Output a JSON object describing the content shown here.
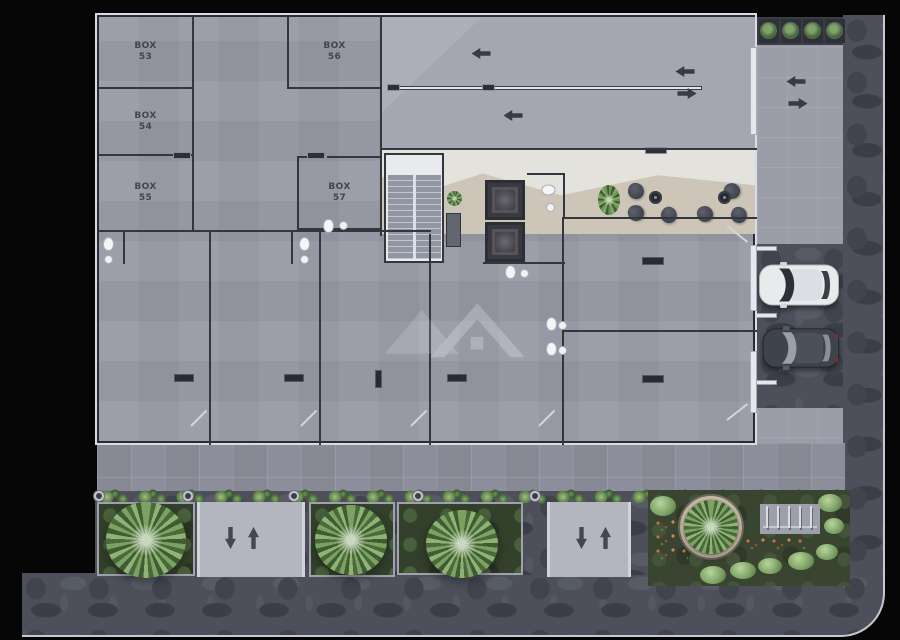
{
  "floor_plan": {
    "box_labels": [
      {
        "label": "BOX",
        "number": "53"
      },
      {
        "label": "BOX",
        "number": "54"
      },
      {
        "label": "BOX",
        "number": "55"
      },
      {
        "label": "BOX",
        "number": "56"
      },
      {
        "label": "BOX",
        "number": "57"
      }
    ],
    "flow_arrows": {
      "ramp_upper_lane": "left",
      "ramp_lower_lane": "left",
      "entrance_inner": "left-right",
      "entrance_outer": "left-right",
      "street_ramp_1": "down-up",
      "street_ramp_2": "down-up"
    },
    "vehicles": [
      {
        "type": "car",
        "color": "white"
      },
      {
        "type": "car",
        "color": "dark-gray"
      }
    ],
    "features": {
      "elevator_count": 2,
      "stair_flights": 2,
      "lobby_chairs": 6,
      "lobby_tables": 2,
      "street_bollards": 7,
      "entrance_shrubs": 4,
      "palm_planters": 4,
      "bike_rack_posts": 5
    },
    "colors": {
      "background": "#060607",
      "floor": "#979aa5",
      "ramp_floor": "#a4a7b2",
      "lobby_beige": "#cdc5b8",
      "lobby_terrazzo": "#e4e2dc",
      "wall_dark": "#34363e",
      "wall_light": "#dde0e8",
      "street_stone": "#4d505a",
      "sidewalk": "#8c8f9b",
      "planter_green": "#33402c",
      "foliage": "#7ca263",
      "arrow": "#383c44",
      "car_white": "#e9eaec",
      "car_dark": "#3f434c",
      "watermark": "#ffffff"
    }
  }
}
